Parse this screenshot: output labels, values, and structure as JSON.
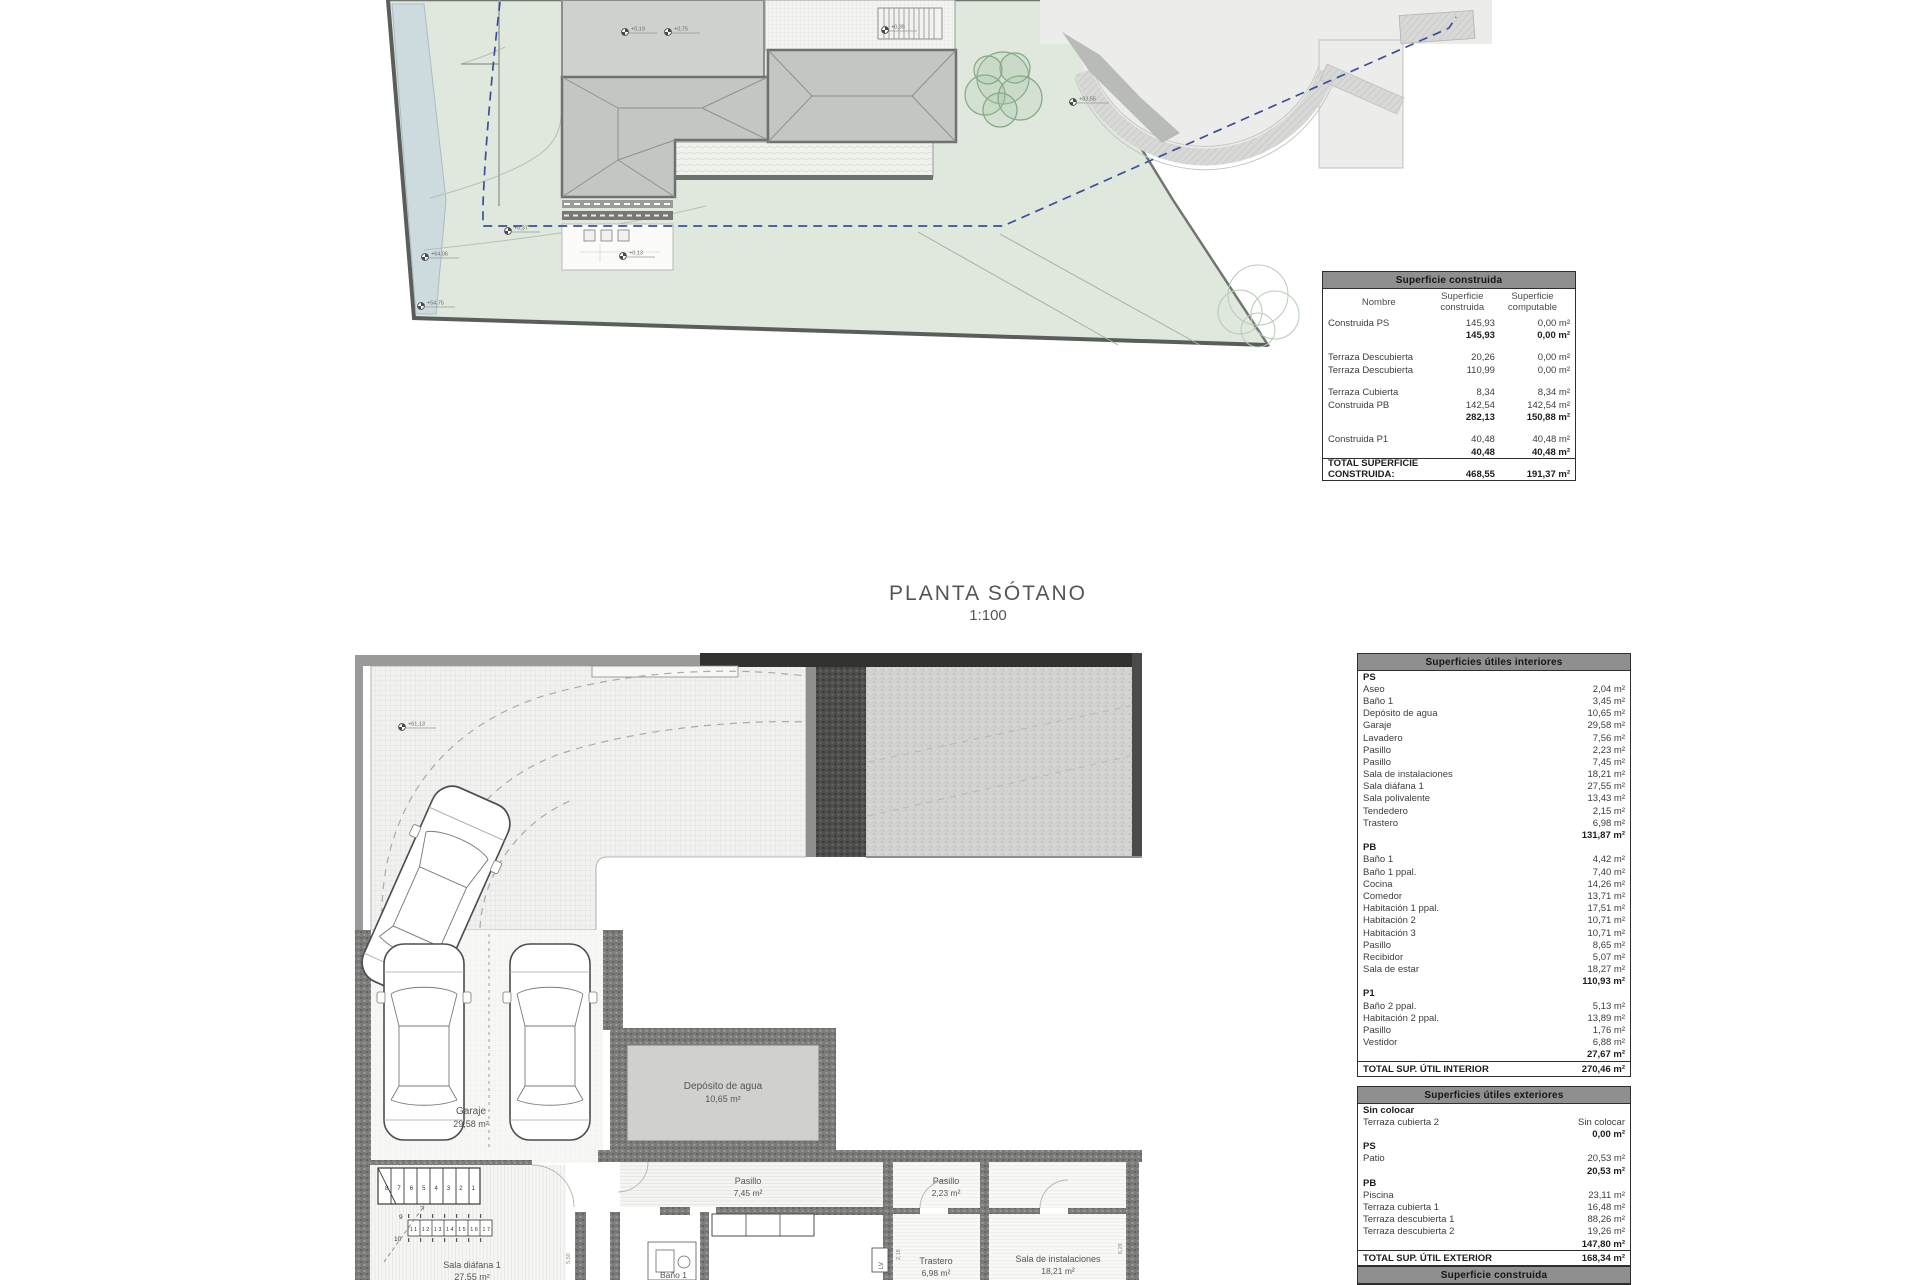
{
  "title": {
    "line1": "PLANTA SÓTANO",
    "line2": "1:100"
  },
  "site": {
    "markers": [
      "+0,19",
      "+0,75",
      "+0,35",
      "+83,55",
      "+0,37",
      "+0,13",
      "+64,06",
      "+54,75"
    ]
  },
  "basement": {
    "marker": "+61,13",
    "rooms": {
      "garaje": {
        "name": "Garaje",
        "area": "29,58 m²"
      },
      "deposito": {
        "name": "Depósito de agua",
        "area": "10,65 m²"
      },
      "pasillo_a": {
        "name": "Pasillo",
        "area": "7,45 m²"
      },
      "pasillo_b": {
        "name": "Pasillo",
        "area": "2,23 m²"
      },
      "trastero": {
        "name": "Trastero",
        "area": "6,98 m²"
      },
      "sala_instalaciones": {
        "name": "Sala de instalaciones",
        "area": "18,21 m²"
      },
      "sala_diafana": {
        "name": "Sala diáfana 1",
        "area": "27,55 m²"
      },
      "bano": {
        "name": "Baño 1"
      }
    },
    "stairs": {
      "row1": "8 7 6 5 4 3 2 1",
      "n9": "9",
      "n10": "10",
      "row2": "11 12 13 14 15 16 17"
    },
    "dims": {
      "d1": "5,50",
      "d2": "2,18",
      "d3": "6,29",
      "d4": "9,50",
      "d5": "7,30",
      "d6": "3,41"
    }
  },
  "tables": {
    "construida": {
      "title": "Superficie construida",
      "rows": [
        {
          "cls": "head",
          "c": [
            "Nombre",
            "Superficie\nconstruida",
            "Superficie\ncomputable"
          ]
        },
        {
          "c": [
            "Construida PS",
            "145,93",
            "0,00 m²"
          ]
        },
        {
          "cls": "b",
          "c": [
            "",
            "145,93",
            "0,00 m²"
          ]
        },
        {
          "cls": "gap",
          "c": [
            "",
            "",
            ""
          ]
        },
        {
          "c": [
            "Terraza Descubierta",
            "20,26",
            "0,00 m²"
          ]
        },
        {
          "c": [
            "Terraza Descubierta",
            "110,99",
            "0,00 m²"
          ]
        },
        {
          "cls": "gap",
          "c": [
            "",
            "",
            ""
          ]
        },
        {
          "c": [
            "Terraza Cubierta",
            "8,34",
            "8,34 m²"
          ]
        },
        {
          "c": [
            "Construida PB",
            "142,54",
            "142,54 m²"
          ]
        },
        {
          "cls": "b",
          "c": [
            "",
            "282,13",
            "150,88 m²"
          ]
        },
        {
          "cls": "gap",
          "c": [
            "",
            "",
            ""
          ]
        },
        {
          "c": [
            "Construida P1",
            "40,48",
            "40,48 m²"
          ]
        },
        {
          "cls": "b",
          "c": [
            "",
            "40,48",
            "40,48 m²"
          ]
        },
        {
          "cls": "tot",
          "c": [
            "TOTAL SUPERFICIE CONSTRUIDA:",
            "468,55",
            "191,37 m²"
          ]
        }
      ]
    },
    "interior": {
      "title": "Superficies útiles interiores",
      "rows": [
        {
          "cls": "sec",
          "c": [
            "PS",
            ""
          ]
        },
        {
          "c": [
            "Aseo",
            "2,04 m²"
          ]
        },
        {
          "c": [
            "Baño 1",
            "3,45 m²"
          ]
        },
        {
          "c": [
            "Depósito de agua",
            "10,65 m²"
          ]
        },
        {
          "c": [
            "Garaje",
            "29,58 m²"
          ]
        },
        {
          "c": [
            "Lavadero",
            "7,56 m²"
          ]
        },
        {
          "c": [
            "Pasillo",
            "2,23 m²"
          ]
        },
        {
          "c": [
            "Pasillo",
            "7,45 m²"
          ]
        },
        {
          "c": [
            "Sala de instalaciones",
            "18,21 m²"
          ]
        },
        {
          "c": [
            "Sala diáfana 1",
            "27,55 m²"
          ]
        },
        {
          "c": [
            "Sala polivalente",
            "13,43 m²"
          ]
        },
        {
          "c": [
            "Tendedero",
            "2,15 m²"
          ]
        },
        {
          "c": [
            "Trastero",
            "6,98 m²"
          ]
        },
        {
          "cls": "b",
          "c": [
            "",
            "131,87 m²"
          ]
        },
        {
          "cls": "sec",
          "c": [
            "PB",
            ""
          ]
        },
        {
          "c": [
            "Baño 1",
            "4,42 m²"
          ]
        },
        {
          "c": [
            "Baño 1 ppal.",
            "7,40 m²"
          ]
        },
        {
          "c": [
            "Cocina",
            "14,26 m²"
          ]
        },
        {
          "c": [
            "Comedor",
            "13,71 m²"
          ]
        },
        {
          "c": [
            "Habitación 1 ppal.",
            "17,51 m²"
          ]
        },
        {
          "c": [
            "Habitación 2",
            "10,71 m²"
          ]
        },
        {
          "c": [
            "Habitación 3",
            "10,71 m²"
          ]
        },
        {
          "c": [
            "Pasillo",
            "8,65 m²"
          ]
        },
        {
          "c": [
            "Recibidor",
            "5,07 m²"
          ]
        },
        {
          "c": [
            "Sala de estar",
            "18,27 m²"
          ]
        },
        {
          "cls": "b",
          "c": [
            "",
            "110,93 m²"
          ]
        },
        {
          "cls": "sec",
          "c": [
            "P1",
            ""
          ]
        },
        {
          "c": [
            "Baño 2 ppal.",
            "5,13 m²"
          ]
        },
        {
          "c": [
            "Habitación 2 ppal.",
            "13,89 m²"
          ]
        },
        {
          "c": [
            "Pasillo",
            "1,76 m²"
          ]
        },
        {
          "c": [
            "Vestidor",
            "6,88 m²"
          ]
        },
        {
          "cls": "b",
          "c": [
            "",
            "27,67 m²"
          ]
        },
        {
          "cls": "tot",
          "c": [
            "TOTAL SUP. ÚTIL INTERIOR",
            "270,46 m²"
          ]
        }
      ]
    },
    "exterior": {
      "title": "Superficies útiles exteriores",
      "rows": [
        {
          "cls": "sec",
          "c": [
            "Sin colocar",
            ""
          ]
        },
        {
          "c": [
            "Terraza cubierta 2",
            "Sin colocar"
          ]
        },
        {
          "cls": "b",
          "c": [
            "",
            "0,00 m²"
          ]
        },
        {
          "cls": "sec",
          "c": [
            "PS",
            ""
          ]
        },
        {
          "c": [
            "Patio",
            "20,53 m²"
          ]
        },
        {
          "cls": "b",
          "c": [
            "",
            "20,53 m²"
          ]
        },
        {
          "cls": "sec",
          "c": [
            "PB",
            ""
          ]
        },
        {
          "c": [
            "Piscina",
            "23,11 m²"
          ]
        },
        {
          "c": [
            "Terraza cubierta 1",
            "16,48 m²"
          ]
        },
        {
          "c": [
            "Terraza descubierta 1",
            "88,26 m²"
          ]
        },
        {
          "c": [
            "Terraza descubierta 2",
            "19,26 m²"
          ]
        },
        {
          "cls": "b",
          "c": [
            "",
            "147,80 m²"
          ]
        },
        {
          "cls": "tot",
          "c": [
            "TOTAL SUP. ÚTIL EXTERIOR",
            "168,34 m²"
          ]
        }
      ]
    },
    "footer": {
      "title": "Superficie construida"
    }
  },
  "colors": {
    "terrain": "#e0e7dd",
    "water_strip": "#cddade",
    "road": "#ececeb",
    "roof": "#c3c6c3",
    "setback_dash": "#3c4f9e",
    "wall_dark": "#323230",
    "table_header": "#8f8f8f"
  }
}
